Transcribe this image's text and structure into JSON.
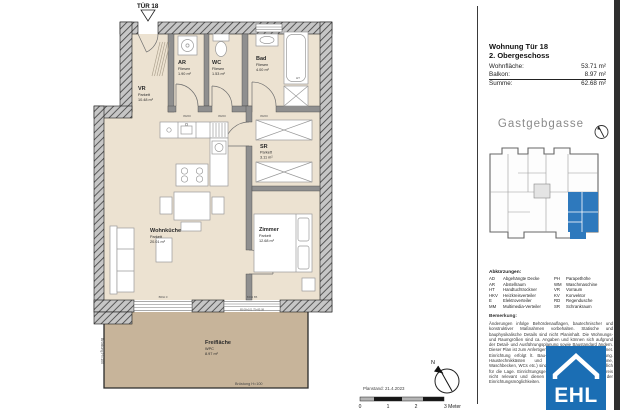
{
  "plan": {
    "tuer_label": "TÜR 18",
    "rooms": {
      "vr": {
        "name": "VR",
        "floor": "Parkett",
        "area": "10.48 m²"
      },
      "ar": {
        "name": "AR",
        "floor": "Fliesen",
        "area": "1.90 m²"
      },
      "wc": {
        "name": "WC",
        "floor": "Fliesen",
        "area": "1.53 m²"
      },
      "bad": {
        "name": "Bad",
        "floor": "Fliesen",
        "area": "4.00 m²"
      },
      "wohnkueche": {
        "name": "Wohnküche",
        "floor": "Parkett",
        "area": "20.01 m²"
      },
      "sr": {
        "name": "SR",
        "floor": "Parkett",
        "area": "3.11 m²"
      },
      "zimmer": {
        "name": "Zimmer",
        "floor": "Parkett",
        "area": "12.68 m²"
      },
      "freiflaeche": {
        "name": "Freifläche",
        "floor": "WPC",
        "area": "8.97 m²"
      }
    },
    "tags": {
      "door": "80/20",
      "window_left": "BRH 0",
      "window_right": "BRH 85",
      "ht": "HT",
      "parapet": "Brüstung H=100",
      "dim_chain": "85.08+101.75+85.08"
    },
    "planstand": "Planstand: 21.4.2023",
    "compass_n": "N",
    "scale_ticks": [
      "0",
      "1",
      "2",
      "3 Meter"
    ]
  },
  "panel": {
    "title": "Wohnung Tür 18",
    "subtitle": "2. Obergeschoss",
    "area_rows": [
      {
        "label": "Wohnfläche:",
        "value": "53.71 m²"
      },
      {
        "label": "Balkon:",
        "value": "8.97 m²"
      },
      {
        "label": "Summe:",
        "value": "62.68 m²"
      }
    ],
    "street": "Gastgebgasse",
    "abbr_title": "Abkürzungen:",
    "abbr_left": [
      {
        "code": "AD",
        "term": "Abgehängte Decke"
      },
      {
        "code": "AR",
        "term": "Abstellraum"
      },
      {
        "code": "HT",
        "term": "Handtuchtrockner"
      },
      {
        "code": "HKV",
        "term": "Heizkreisverteiler"
      },
      {
        "code": "E",
        "term": "Elektroverteiler"
      },
      {
        "code": "MM",
        "term": "Multimedia-Verteiler"
      }
    ],
    "abbr_right": [
      {
        "code": "PH",
        "term": "Parapethöhe"
      },
      {
        "code": "WM",
        "term": "Waschmaschine"
      },
      {
        "code": "VR",
        "term": "Vorraum"
      },
      {
        "code": "KV",
        "term": "Konvektor"
      },
      {
        "code": "RD",
        "term": "Regendusche"
      },
      {
        "code": "SR",
        "term": "Schrankraum"
      }
    ],
    "remark_title": "Bemerkung:",
    "remark_text": "Änderungen infolge Behördenauflagen, bautechnischer und konstruktiver Maßnahmen vorbehalten. Statische und bauphysikalische Details sind nicht Planinhalt. Die Wohnungs- und Raumgrößen sind ca. Angaben und können sich aufgrund der Detail- und Ausführungsplanung sowie Baustandard ändern. Dieser Plan ist zum Anfertigen von Einbaumöbeln nicht geeignet. Einrichtung erfolgt lt. Bau- und Ausstattungsbeschreibung. Haustechnikkästen und Sanitärobjekte (Badewanne, Waschbecken, WCs etc.) sind nicht maßstäblich und verbindlich für die Lage. Einrichtungsgegenstände sind für den Kaufpreis nicht relevant und dienen nur der Veranschaulichung der Einrichtungsmöglichkeiten.",
    "logo_text": "EHL",
    "colors": {
      "unit_blue": "#2e79bd",
      "logo_blue": "#1b6eb4"
    }
  }
}
